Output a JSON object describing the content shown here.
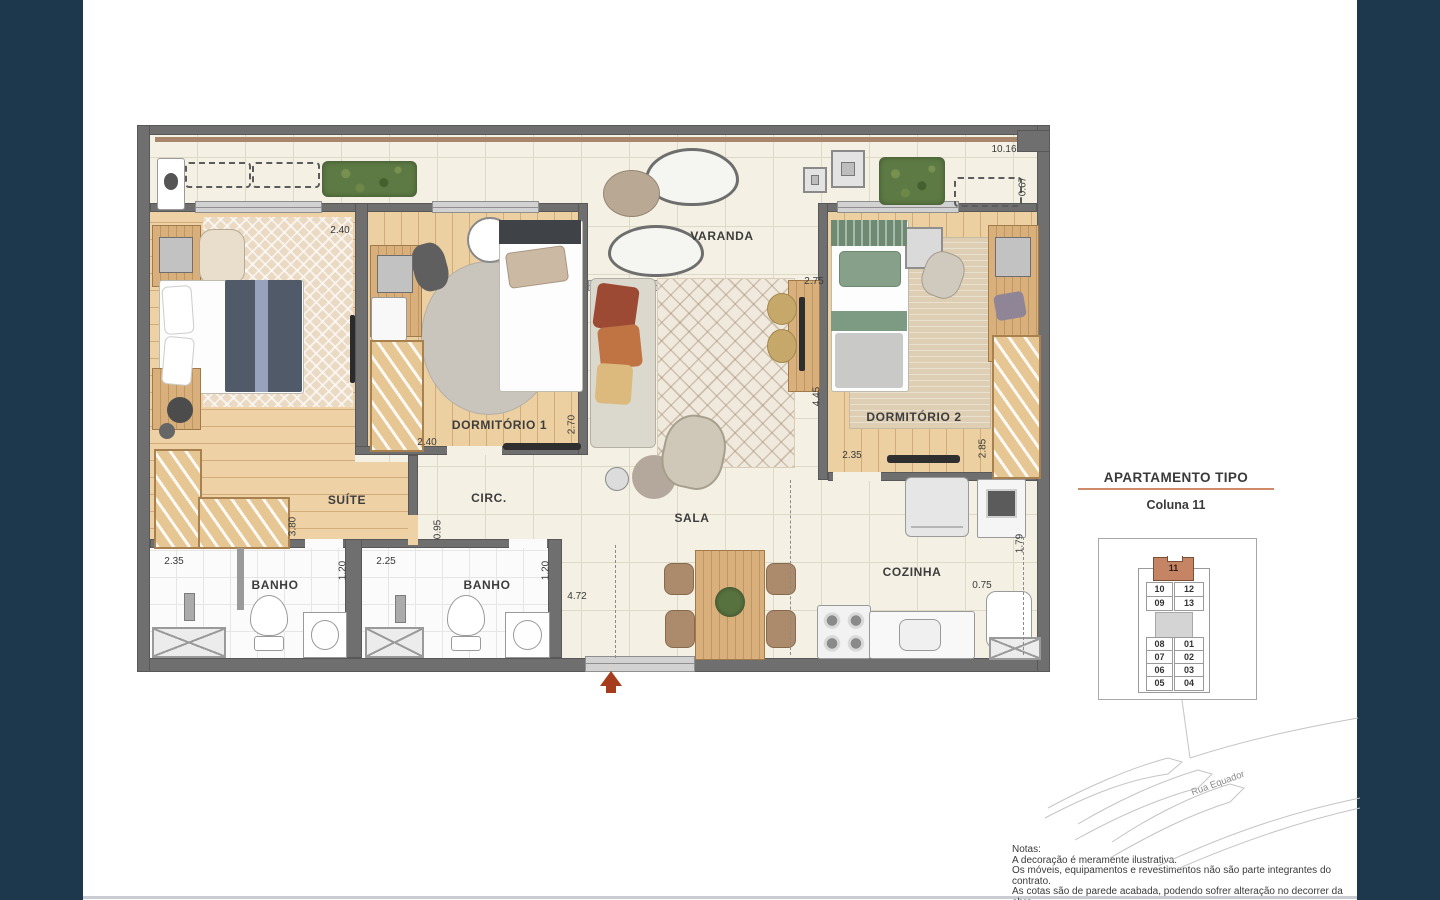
{
  "plan": {
    "room_labels": {
      "suite": "SUÍTE",
      "dorm1": "DORMITÓRIO 1",
      "dorm2": "DORMITÓRIO 2",
      "varanda": "VARANDA",
      "sala": "SALA",
      "circ": "CIRC.",
      "banho1": "BANHO",
      "banho2": "BANHO",
      "cozinha": "COZINHA"
    },
    "dims": {
      "suite_w": "2.40",
      "suite_h": "3.80",
      "dorm1_w": "2.40",
      "dorm1_h": "2.70",
      "sala_w": "2.75",
      "sala_h": "4.45",
      "dorm2_w": "2.35",
      "dorm2_h": "2.85",
      "circ_h": "0.95",
      "banho1_w": "2.35",
      "banho1_h": "1.20",
      "banho2_w": "2.25",
      "banho2_h": "1.20",
      "entry_w": "4.72",
      "cozinha_w": "0.75",
      "cozinha_h": "1.79",
      "top_w": "10.16",
      "top_h": "0.67"
    },
    "colors": {
      "navy": "#1d374d",
      "accent_salmon": "#cf8a68",
      "entry_arrow": "#a63c1e"
    }
  },
  "sidebar": {
    "title": "APARTAMENTO TIPO",
    "subtitle": "Coluna 11",
    "keyplan": {
      "highlighted_unit": "11",
      "rows": [
        {
          "left": "10",
          "right": "12"
        },
        {
          "left": "09",
          "right": "13"
        },
        {
          "left": "08",
          "right": "01"
        },
        {
          "left": "07",
          "right": "02"
        },
        {
          "left": "06",
          "right": "03"
        },
        {
          "left": "05",
          "right": "04"
        }
      ]
    },
    "street_label": "Rua Equador"
  },
  "notes": {
    "heading": "Notas:",
    "lines": [
      "A decoração é meramente ilustrativa.",
      "Os móveis, equipamentos e revestimentos não são parte integrantes do contrato.",
      "As cotas são de parede acabada, podendo sofrer alteração no decorrer da obra."
    ]
  }
}
